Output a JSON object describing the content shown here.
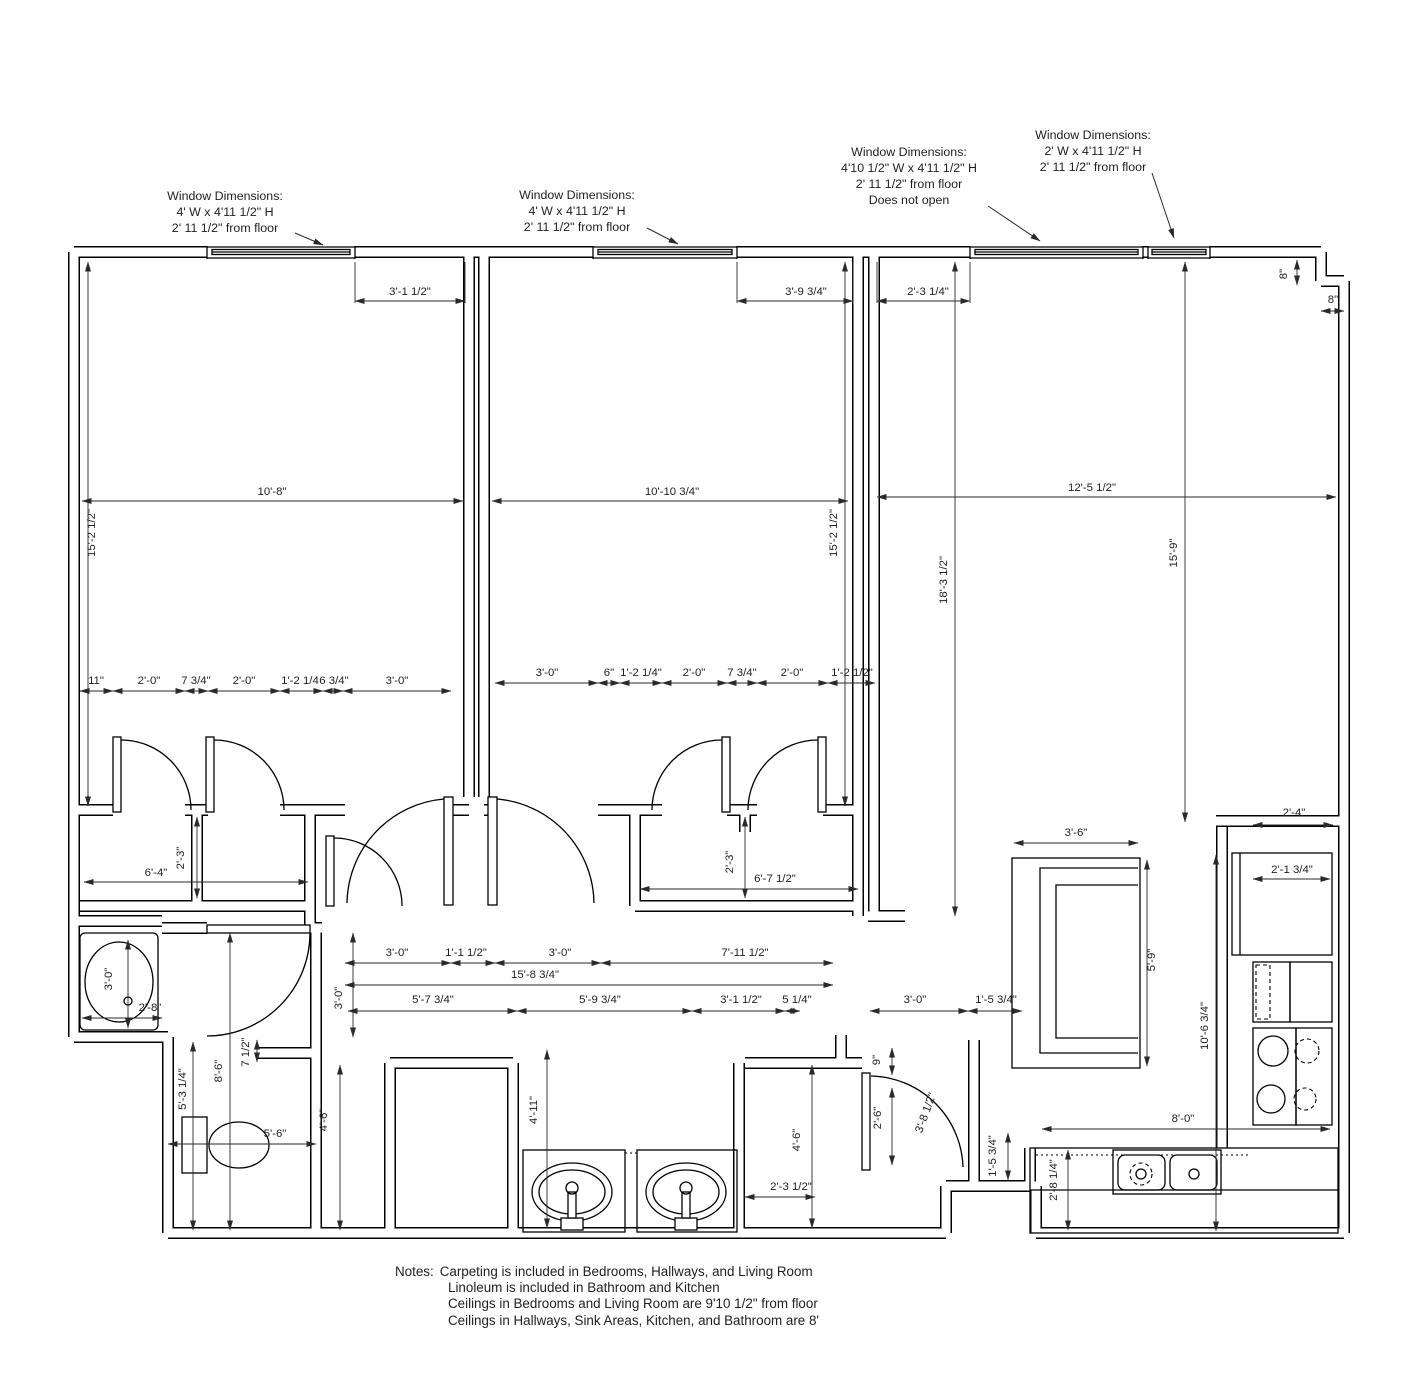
{
  "colors": {
    "line": "#000000",
    "text": "#1f1f1f",
    "background": "#ffffff"
  },
  "window_annotations": [
    {
      "name": "bedroom1-window-note",
      "x": 225,
      "y": 200,
      "lines": [
        "Window Dimensions:",
        "4' W x 4'11 1/2\" H",
        "2' 11 1/2\" from floor"
      ],
      "leader": [
        295,
        233,
        323,
        245
      ]
    },
    {
      "name": "bedroom2-window-note",
      "x": 577,
      "y": 199,
      "lines": [
        "Window Dimensions:",
        "4' W x 4'11 1/2\" H",
        "2' 11 1/2\" from floor"
      ],
      "leader": [
        647,
        228,
        678,
        244
      ]
    },
    {
      "name": "living-large-window-note",
      "x": 909,
      "y": 156,
      "lines": [
        "Window Dimensions:",
        "4'10 1/2\" W x 4'11 1/2\" H",
        "2' 11 1/2\" from floor",
        "Does not open"
      ],
      "leader": [
        988,
        206,
        1040,
        241
      ]
    },
    {
      "name": "living-small-window-note",
      "x": 1093,
      "y": 139,
      "lines": [
        "Window Dimensions:",
        "2' W x 4'11 1/2\" H",
        "2' 11 1/2\" from floor"
      ],
      "leader": [
        1152,
        173,
        1174,
        238
      ]
    }
  ],
  "dimensions": [
    {
      "t": "3'-1 1/2\"",
      "x": 410,
      "y": 295,
      "r": 0,
      "l": [
        355,
        301,
        465,
        301
      ]
    },
    {
      "t": "3'-9 3/4\"",
      "x": 806,
      "y": 295,
      "r": 0,
      "l": [
        737,
        301,
        853,
        301
      ]
    },
    {
      "t": "2'-3 1/4\"",
      "x": 928,
      "y": 295,
      "r": 0,
      "l": [
        877,
        301,
        970,
        301
      ]
    },
    {
      "t": "8\"",
      "x": 1287,
      "y": 274,
      "r": -90,
      "l": [
        1297,
        260,
        1297,
        285
      ]
    },
    {
      "t": "8\"",
      "x": 1333,
      "y": 303,
      "r": 0,
      "l": [
        1321,
        311,
        1344,
        311
      ]
    },
    {
      "t": "10'-8\"",
      "x": 272,
      "y": 495,
      "r": 0,
      "l": [
        82,
        501,
        463,
        501
      ]
    },
    {
      "t": "10'-10 3/4\"",
      "x": 672,
      "y": 495,
      "r": 0,
      "l": [
        492,
        501,
        848,
        501
      ]
    },
    {
      "t": "12'-5 1/2\"",
      "x": 1092,
      "y": 491,
      "r": 0,
      "l": [
        877,
        497,
        1336,
        497
      ]
    },
    {
      "t": "15'-2 1/2\"",
      "x": 95,
      "y": 533,
      "r": -90,
      "l": [
        88,
        262,
        88,
        806
      ]
    },
    {
      "t": "15'-2 1/2\"",
      "x": 837,
      "y": 533,
      "r": -90,
      "l": [
        845,
        262,
        845,
        806
      ]
    },
    {
      "t": "18'-3 1/2\"",
      "x": 947,
      "y": 580,
      "r": -90,
      "l": [
        955,
        262,
        955,
        916
      ]
    },
    {
      "t": "15'-9\"",
      "x": 1177,
      "y": 553,
      "r": -90,
      "l": [
        1185,
        262,
        1185,
        822
      ]
    },
    {
      "t": "11\"",
      "x": 96,
      "y": 684,
      "r": 0,
      "l": [
        80,
        691,
        113,
        691
      ]
    },
    {
      "t": "2'-0\"",
      "x": 149,
      "y": 684,
      "r": 0,
      "l": [
        113,
        691,
        185,
        691
      ]
    },
    {
      "t": "7 3/4\"",
      "x": 196,
      "y": 684,
      "r": 0,
      "l": [
        185,
        691,
        208,
        691
      ]
    },
    {
      "t": "2'-0\"",
      "x": 244,
      "y": 684,
      "r": 0,
      "l": [
        208,
        691,
        280,
        691
      ]
    },
    {
      "t": "1'-2 1/4",
      "x": 300,
      "y": 684,
      "r": 0,
      "l": [
        280,
        691,
        323,
        691
      ]
    },
    {
      "t": "6 3/4\"",
      "x": 334,
      "y": 684,
      "r": 0,
      "l": [
        323,
        691,
        343,
        691
      ]
    },
    {
      "t": "3'-0\"",
      "x": 397,
      "y": 684,
      "r": 0,
      "l": [
        343,
        691,
        451,
        691
      ]
    },
    {
      "t": "3'-0\"",
      "x": 547,
      "y": 676,
      "r": 0,
      "l": [
        495,
        683,
        598,
        683
      ]
    },
    {
      "t": "6\"",
      "x": 609,
      "y": 676,
      "r": 0,
      "l": [
        598,
        683,
        620,
        683
      ]
    },
    {
      "t": "1'-2 1/4\"",
      "x": 641,
      "y": 676,
      "r": 0,
      "l": [
        620,
        683,
        662,
        683
      ]
    },
    {
      "t": "2'-0\"",
      "x": 694,
      "y": 676,
      "r": 0,
      "l": [
        662,
        683,
        727,
        683
      ]
    },
    {
      "t": "7 3/4\"",
      "x": 742,
      "y": 676,
      "r": 0,
      "l": [
        727,
        683,
        757,
        683
      ]
    },
    {
      "t": "2'-0\"",
      "x": 792,
      "y": 676,
      "r": 0,
      "l": [
        757,
        683,
        828,
        683
      ]
    },
    {
      "t": "1'-2 1/2\"",
      "x": 852,
      "y": 676,
      "r": 0,
      "l": [
        828,
        683,
        875,
        683
      ]
    },
    {
      "t": "6'-4\"",
      "x": 156,
      "y": 876,
      "r": 0,
      "l": [
        84,
        882,
        308,
        882
      ]
    },
    {
      "t": "2'-3\"",
      "x": 184,
      "y": 858,
      "r": -90,
      "l": [
        197,
        817,
        197,
        898
      ]
    },
    {
      "t": "2'-3\"",
      "x": 733,
      "y": 862,
      "r": -90,
      "l": [
        745,
        817,
        745,
        898
      ]
    },
    {
      "t": "6'-7 1/2\"",
      "x": 775,
      "y": 882,
      "r": 0,
      "l": [
        640,
        889,
        858,
        889
      ]
    },
    {
      "t": "3'-0\"",
      "x": 112,
      "y": 979,
      "r": -90,
      "l": [
        128,
        940,
        128,
        1028
      ]
    },
    {
      "t": "2'-8\"",
      "x": 150,
      "y": 1011,
      "r": 0,
      "l": [
        82,
        1018,
        162,
        1018
      ]
    },
    {
      "t": "3'-0\"",
      "x": 397,
      "y": 956,
      "r": 0,
      "l": [
        345,
        963,
        451,
        963
      ]
    },
    {
      "t": "1'-1 1/2\"",
      "x": 466,
      "y": 956,
      "r": 0,
      "l": [
        451,
        963,
        495,
        963
      ]
    },
    {
      "t": "3'-0\"",
      "x": 560,
      "y": 956,
      "r": 0,
      "l": [
        495,
        963,
        601,
        963
      ]
    },
    {
      "t": "7'-11 1/2\"",
      "x": 745,
      "y": 956,
      "r": 0,
      "l": [
        601,
        963,
        833,
        963
      ]
    },
    {
      "t": "15'-8 3/4\"",
      "x": 535,
      "y": 978,
      "r": 0,
      "l": [
        345,
        985,
        833,
        985
      ]
    },
    {
      "t": "3'-0\"",
      "x": 342,
      "y": 998,
      "r": -90,
      "l": [
        353,
        933,
        353,
        1037
      ]
    },
    {
      "t": "5'-7 3/4\"",
      "x": 433,
      "y": 1003,
      "r": 0,
      "l": [
        348,
        1011,
        517,
        1011
      ]
    },
    {
      "t": "5'-9 3/4\"",
      "x": 600,
      "y": 1003,
      "r": 0,
      "l": [
        517,
        1011,
        692,
        1011
      ]
    },
    {
      "t": "3'-1 1/2\"",
      "x": 741,
      "y": 1003,
      "r": 0,
      "l": [
        692,
        1011,
        785,
        1011
      ]
    },
    {
      "t": "5 1/4\"",
      "x": 797,
      "y": 1003,
      "r": 0,
      "l": [
        785,
        1011,
        800,
        1011
      ]
    },
    {
      "t": "3'-0\"",
      "x": 915,
      "y": 1003,
      "r": 0,
      "l": [
        870,
        1011,
        968,
        1011
      ]
    },
    {
      "t": "1'-5 3/4\"",
      "x": 996,
      "y": 1003,
      "r": 0,
      "l": [
        968,
        1011,
        1022,
        1011
      ]
    },
    {
      "t": "5'-3 1/4\"",
      "x": 186,
      "y": 1089,
      "r": -90,
      "l": [
        193,
        1042,
        193,
        1230
      ]
    },
    {
      "t": "8'-6\"",
      "x": 222,
      "y": 1071,
      "r": -90,
      "l": [
        230,
        933,
        230,
        1230
      ]
    },
    {
      "t": "7 1/2\"",
      "x": 249,
      "y": 1052,
      "r": -90,
      "l": [
        257,
        1040,
        257,
        1062
      ]
    },
    {
      "t": "5'-6\"",
      "x": 275,
      "y": 1137,
      "r": 0,
      "l": [
        168,
        1144,
        316,
        1144
      ]
    },
    {
      "t": "4'-6\"",
      "x": 327,
      "y": 1120,
      "r": -90,
      "l": [
        340,
        1065,
        340,
        1230
      ]
    },
    {
      "t": "4'-11\"",
      "x": 537,
      "y": 1110,
      "r": -90,
      "l": [
        547,
        1050,
        547,
        1228
      ]
    },
    {
      "t": "2'-3 1/2\"",
      "x": 791,
      "y": 1190,
      "r": 0,
      "l": [
        745,
        1197,
        815,
        1197
      ]
    },
    {
      "t": "4'-6\"",
      "x": 800,
      "y": 1140,
      "r": -90,
      "l": [
        812,
        1065,
        812,
        1228
      ]
    },
    {
      "t": "9\"",
      "x": 880,
      "y": 1060,
      "r": -90,
      "l": [
        892,
        1048,
        892,
        1075
      ]
    },
    {
      "t": "2'-6\"",
      "x": 881,
      "y": 1118,
      "r": -90,
      "l": [
        892,
        1088,
        892,
        1165
      ]
    },
    {
      "t": "3'-8 1/2\"",
      "x": 929,
      "y": 1114,
      "r": -70,
      "l": null
    },
    {
      "t": "1'-5 3/4\"",
      "x": 996,
      "y": 1156,
      "r": -90,
      "l": [
        1008,
        1133,
        1008,
        1180
      ]
    },
    {
      "t": "3'-6\"",
      "x": 1076,
      "y": 836,
      "r": 0,
      "l": [
        1014,
        843,
        1138,
        843
      ]
    },
    {
      "t": "5'-9\"",
      "x": 1155,
      "y": 960,
      "r": -90,
      "l": [
        1147,
        860,
        1147,
        1066
      ]
    },
    {
      "t": "10'-6 3/4\"",
      "x": 1208,
      "y": 1026,
      "r": -90,
      "l": [
        1216,
        855,
        1216,
        1231
      ]
    },
    {
      "t": "2'-4\"",
      "x": 1294,
      "y": 816,
      "r": 0,
      "l": [
        1253,
        825,
        1333,
        825
      ]
    },
    {
      "t": "2'-1 3/4\"",
      "x": 1292,
      "y": 873,
      "r": 0,
      "l": [
        1253,
        879,
        1330,
        879
      ]
    },
    {
      "t": "8'-0\"",
      "x": 1183,
      "y": 1122,
      "r": 0,
      "l": [
        1042,
        1129,
        1330,
        1129
      ]
    },
    {
      "t": "2'-8 1/4\"",
      "x": 1057,
      "y": 1180,
      "r": -90,
      "l": [
        1068,
        1150,
        1068,
        1230
      ]
    }
  ],
  "notes": {
    "label": "Notes:",
    "lines": [
      "Carpeting is included in Bedrooms, Hallways, and Living Room",
      "Linoleum is included in Bathroom and Kitchen",
      "Ceilings in Bedrooms and Living Room are 9'10 1/2\" from floor",
      "Ceilings in Hallways, Sink Areas, Kitchen, and Bathroom are 8'"
    ]
  }
}
